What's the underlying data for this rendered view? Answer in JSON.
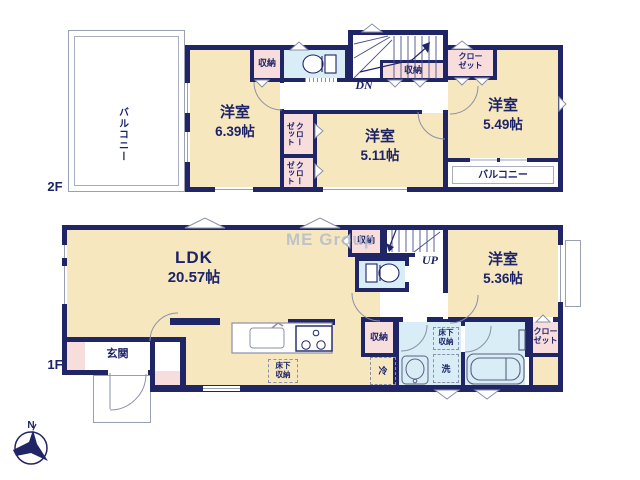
{
  "watermark": "ME Group",
  "compass": {
    "north_label": "N"
  },
  "colors": {
    "wall": "#202566",
    "room_cream": "#f6e7bf",
    "storage_pink": "#f8dddd",
    "wet_blue": "#d9edf6",
    "text_navy": "#1c2368",
    "outline_gray": "#9aa0b4",
    "watermark_gray": "#b6bcc8"
  },
  "f2": {
    "floor_label": "2F",
    "balcony_left_label": "バルコニー",
    "balcony_right_label": "バルコニー",
    "room_639": {
      "name": "洋室",
      "area": "6.39帖"
    },
    "room_511": {
      "name": "洋室",
      "area": "5.11帖"
    },
    "room_549": {
      "name": "洋室",
      "area": "5.49帖"
    },
    "storage_top_label": "収納",
    "storage_under_stairs_label": "収納",
    "closet_mid_upper": {
      "l1": "クロー",
      "l2": "ゼット"
    },
    "closet_mid_lower": {
      "l1": "クロー",
      "l2": "ゼット"
    },
    "closet_right": {
      "l1": "クロー",
      "l2": "ゼット"
    },
    "stairs_label": "DN"
  },
  "f1": {
    "floor_label": "1F",
    "ldk": {
      "name": "LDK",
      "area": "20.57帖"
    },
    "room_536": {
      "name": "洋室",
      "area": "5.36帖"
    },
    "entrance_label": "玄関",
    "storage_top_label": "収納",
    "storage_mid_label": "収納",
    "closet_right": {
      "l1": "クロー",
      "l2": "ゼット"
    },
    "underfloor_kitchen": {
      "l1": "床下",
      "l2": "収納"
    },
    "underfloor_wash": {
      "l1": "床下",
      "l2": "収納"
    },
    "fridge_label": "冷",
    "laundry_label": "洗",
    "stairs_label": "UP"
  }
}
